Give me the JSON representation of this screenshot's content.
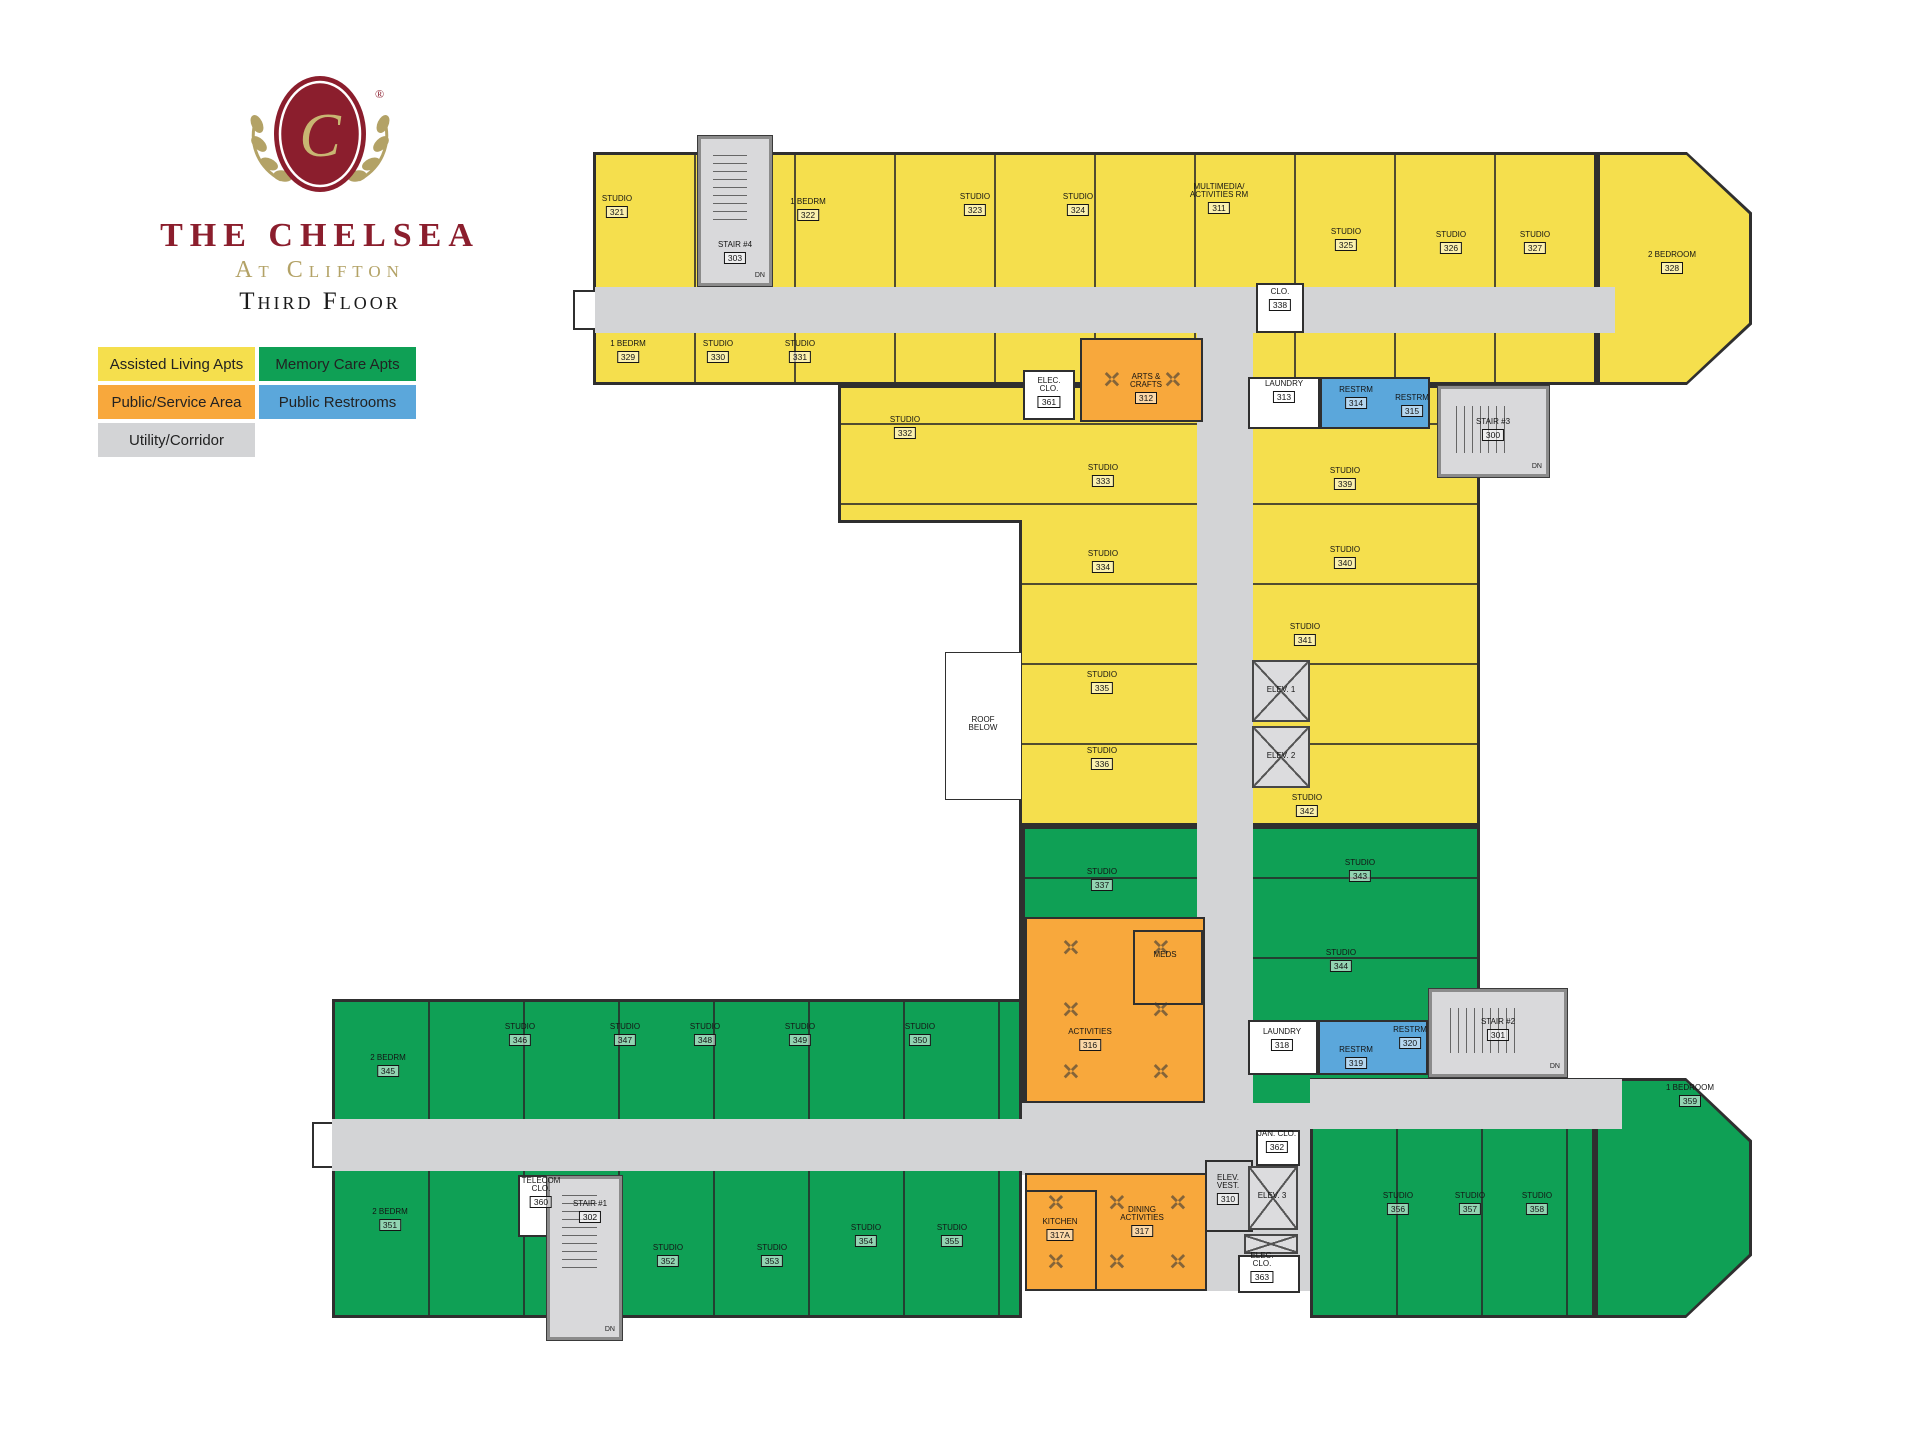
{
  "branding": {
    "monogram": "C",
    "registered": "®",
    "title": "The Chelsea",
    "subtitle": "At Clifton",
    "floor_label": "Third Floor"
  },
  "legend": {
    "items": [
      {
        "label": "Assisted Living Apts",
        "key": "assisted"
      },
      {
        "label": "Memory Care Apts",
        "key": "memory"
      },
      {
        "label": "Public/Service Area",
        "key": "service"
      },
      {
        "label": "Public Restrooms",
        "key": "restroom"
      },
      {
        "label": "Utility/Corridor",
        "key": "corridor"
      }
    ]
  },
  "colors": {
    "assisted": "#F5DF4D",
    "memory": "#0FA055",
    "service": "#F8A83C",
    "restroom": "#5BA7DB",
    "corridor": "#D3D4D6",
    "white": "#FFFFFF",
    "wall": "#2F2F2F",
    "logo_maroon": "#8B1E2D",
    "logo_gold": "#B3A266",
    "text_dark": "#1C1C1C"
  },
  "floorplan": {
    "zones": [
      {
        "name": "top-wing",
        "cat": "assisted",
        "x": 593,
        "y": 152,
        "w": 1004,
        "h": 233,
        "stripes": "v100"
      },
      {
        "name": "top-wing-bay",
        "cat": "assisted",
        "x": 1597,
        "y": 152,
        "w": 155,
        "h": 233,
        "shape": "bay"
      },
      {
        "name": "mid-block",
        "cat": "assisted",
        "x": 838,
        "y": 385,
        "w": 642,
        "h": 441,
        "stripes": "h80"
      },
      {
        "name": "mid-notch",
        "cat": "white",
        "x": 838,
        "y": 520,
        "w": 184,
        "h": 479,
        "edge": "notch"
      },
      {
        "name": "mid-green",
        "cat": "memory",
        "x": 1022,
        "y": 826,
        "w": 458,
        "h": 294,
        "stripes": "h80"
      },
      {
        "name": "bottom-wing",
        "cat": "memory",
        "x": 332,
        "y": 999,
        "w": 690,
        "h": 319,
        "stripes": "v95"
      },
      {
        "name": "bottom-right-wing",
        "cat": "memory",
        "x": 1310,
        "y": 1078,
        "w": 285,
        "h": 240,
        "stripes": "v85"
      },
      {
        "name": "bottom-bay",
        "cat": "memory",
        "x": 1595,
        "y": 1078,
        "w": 157,
        "h": 240,
        "shape": "bay"
      }
    ],
    "corridors": [
      {
        "name": "top-corridor",
        "x": 595,
        "y": 287,
        "w": 1020,
        "h": 46
      },
      {
        "name": "mid-corridor",
        "x": 1197,
        "y": 333,
        "w": 56,
        "h": 838
      },
      {
        "name": "bottom-corridor",
        "x": 332,
        "y": 1119,
        "w": 690,
        "h": 52
      },
      {
        "name": "bottom-right-corridor",
        "x": 1310,
        "y": 1079,
        "w": 312,
        "h": 50
      },
      {
        "name": "central-plaza",
        "x": 1022,
        "y": 1103,
        "w": 288,
        "h": 72
      },
      {
        "name": "elevator-lobby",
        "x": 1205,
        "y": 1129,
        "w": 105,
        "h": 162
      }
    ],
    "entries": [
      {
        "name": "top-corridor-entry",
        "x": 573,
        "y": 290,
        "w": 22,
        "h": 40
      },
      {
        "name": "bottom-corridor-entry",
        "x": 312,
        "y": 1122,
        "w": 20,
        "h": 46
      }
    ],
    "overlays": [
      {
        "name": "arts-crafts-room",
        "cat": "service",
        "x": 1080,
        "y": 338,
        "w": 123,
        "h": 84,
        "tables": [
          2,
          1
        ]
      },
      {
        "name": "activities-room",
        "cat": "service",
        "x": 1025,
        "y": 917,
        "w": 180,
        "h": 186,
        "tables": [
          2,
          3
        ]
      },
      {
        "name": "meds-room",
        "cat": "service",
        "x": 1133,
        "y": 930,
        "w": 70,
        "h": 75
      },
      {
        "name": "dining-room",
        "cat": "service",
        "x": 1025,
        "y": 1173,
        "w": 182,
        "h": 118,
        "tables": [
          3,
          2
        ]
      },
      {
        "name": "kitchen-room",
        "cat": "service",
        "x": 1025,
        "y": 1190,
        "w": 72,
        "h": 101
      },
      {
        "name": "restrooms-314-315",
        "cat": "restroom",
        "x": 1320,
        "y": 377,
        "w": 110,
        "h": 52
      },
      {
        "name": "restrooms-319-320",
        "cat": "restroom",
        "x": 1318,
        "y": 1020,
        "w": 110,
        "h": 55
      },
      {
        "name": "laundry-313-room",
        "cat": "white",
        "x": 1248,
        "y": 377,
        "w": 72,
        "h": 52
      },
      {
        "name": "laundry-318-room",
        "cat": "white",
        "x": 1248,
        "y": 1020,
        "w": 70,
        "h": 55
      },
      {
        "name": "elec-clo-361-room",
        "cat": "white",
        "x": 1023,
        "y": 370,
        "w": 52,
        "h": 50
      },
      {
        "name": "clo-338-room",
        "cat": "white",
        "x": 1256,
        "y": 283,
        "w": 48,
        "h": 50
      },
      {
        "name": "telecom-clo-360-room",
        "cat": "white",
        "x": 518,
        "y": 1175,
        "w": 48,
        "h": 62
      },
      {
        "name": "jan-clo-362-room",
        "cat": "white",
        "x": 1256,
        "y": 1130,
        "w": 44,
        "h": 36
      },
      {
        "name": "elec-clo-363-room",
        "cat": "white",
        "x": 1238,
        "y": 1255,
        "w": 62,
        "h": 38
      },
      {
        "name": "elev-vest-310-room",
        "cat": "corridor",
        "x": 1205,
        "y": 1160,
        "w": 48,
        "h": 72
      },
      {
        "name": "roof-below-box",
        "cat": "white",
        "x": 945,
        "y": 652,
        "w": 77,
        "h": 148,
        "thin": true
      }
    ],
    "stairs": [
      {
        "name": "stair-4-tower",
        "dn": "DN",
        "x": 697,
        "y": 135,
        "w": 76,
        "h": 152,
        "dir": "v"
      },
      {
        "name": "stair-3-tower",
        "dn": "DN",
        "x": 1437,
        "y": 385,
        "w": 113,
        "h": 93,
        "dir": "h"
      },
      {
        "name": "stair-1-tower",
        "dn": "DN",
        "x": 546,
        "y": 1175,
        "w": 77,
        "h": 166,
        "dir": "v"
      },
      {
        "name": "stair-2-tower",
        "dn": "DN",
        "x": 1428,
        "y": 988,
        "w": 140,
        "h": 90,
        "dir": "h"
      }
    ],
    "elevators": [
      {
        "name": "elevator-1",
        "x": 1252,
        "y": 660,
        "w": 58,
        "h": 62
      },
      {
        "name": "elevator-2",
        "x": 1252,
        "y": 726,
        "w": 58,
        "h": 62
      },
      {
        "name": "elevator-3",
        "x": 1248,
        "y": 1166,
        "w": 50,
        "h": 64
      },
      {
        "name": "elevator-shaft",
        "x": 1244,
        "y": 1234,
        "w": 54,
        "h": 20
      }
    ],
    "room_labels": [
      {
        "name": "STUDIO",
        "num": "321",
        "x": 617,
        "y": 207
      },
      {
        "name": "1 BEDRM",
        "num": "322",
        "x": 808,
        "y": 210
      },
      {
        "name": "STUDIO",
        "num": "323",
        "x": 975,
        "y": 205
      },
      {
        "name": "STUDIO",
        "num": "324",
        "x": 1078,
        "y": 205
      },
      {
        "name": "MULTIMEDIA/|ACTIVITIES RM",
        "num": "311",
        "x": 1219,
        "y": 199
      },
      {
        "name": "STUDIO",
        "num": "325",
        "x": 1346,
        "y": 240
      },
      {
        "name": "STUDIO",
        "num": "326",
        "x": 1451,
        "y": 243
      },
      {
        "name": "STUDIO",
        "num": "327",
        "x": 1535,
        "y": 243
      },
      {
        "name": "2 BEDROOM",
        "num": "328",
        "x": 1672,
        "y": 263
      },
      {
        "name": "1 BEDRM",
        "num": "329",
        "x": 628,
        "y": 352
      },
      {
        "name": "STUDIO",
        "num": "330",
        "x": 718,
        "y": 352
      },
      {
        "name": "STUDIO",
        "num": "331",
        "x": 800,
        "y": 352
      },
      {
        "name": "STUDIO",
        "num": "332",
        "x": 905,
        "y": 428
      },
      {
        "name": "STUDIO",
        "num": "333",
        "x": 1103,
        "y": 476
      },
      {
        "name": "STUDIO",
        "num": "334",
        "x": 1103,
        "y": 562
      },
      {
        "name": "STUDIO",
        "num": "335",
        "x": 1102,
        "y": 683
      },
      {
        "name": "STUDIO",
        "num": "336",
        "x": 1102,
        "y": 759
      },
      {
        "name": "STUDIO",
        "num": "337",
        "x": 1102,
        "y": 880
      },
      {
        "name": "STUDIO",
        "num": "339",
        "x": 1345,
        "y": 479
      },
      {
        "name": "STUDIO",
        "num": "340",
        "x": 1345,
        "y": 558
      },
      {
        "name": "STUDIO",
        "num": "341",
        "x": 1305,
        "y": 635
      },
      {
        "name": "STUDIO",
        "num": "342",
        "x": 1307,
        "y": 806
      },
      {
        "name": "STUDIO",
        "num": "343",
        "x": 1360,
        "y": 871
      },
      {
        "name": "STUDIO",
        "num": "344",
        "x": 1341,
        "y": 961
      },
      {
        "name": "2 BEDRM",
        "num": "345",
        "x": 388,
        "y": 1066
      },
      {
        "name": "STUDIO",
        "num": "346",
        "x": 520,
        "y": 1035
      },
      {
        "name": "STUDIO",
        "num": "347",
        "x": 625,
        "y": 1035
      },
      {
        "name": "STUDIO",
        "num": "348",
        "x": 705,
        "y": 1035
      },
      {
        "name": "STUDIO",
        "num": "349",
        "x": 800,
        "y": 1035
      },
      {
        "name": "STUDIO",
        "num": "350",
        "x": 920,
        "y": 1035
      },
      {
        "name": "2 BEDRM",
        "num": "351",
        "x": 390,
        "y": 1220
      },
      {
        "name": "STUDIO",
        "num": "352",
        "x": 668,
        "y": 1256
      },
      {
        "name": "STUDIO",
        "num": "353",
        "x": 772,
        "y": 1256
      },
      {
        "name": "STUDIO",
        "num": "354",
        "x": 866,
        "y": 1236
      },
      {
        "name": "STUDIO",
        "num": "355",
        "x": 952,
        "y": 1236
      },
      {
        "name": "STUDIO",
        "num": "356",
        "x": 1398,
        "y": 1204
      },
      {
        "name": "STUDIO",
        "num": "357",
        "x": 1470,
        "y": 1204
      },
      {
        "name": "STUDIO",
        "num": "358",
        "x": 1537,
        "y": 1204
      },
      {
        "name": "1 BEDROOM",
        "num": "359",
        "x": 1690,
        "y": 1096
      },
      {
        "name": "ELEC.|CLO.",
        "num": "361",
        "x": 1049,
        "y": 393
      },
      {
        "name": "ARTS &|CRAFTS",
        "num": "312",
        "x": 1146,
        "y": 389
      },
      {
        "name": "LAUNDRY",
        "num": "313",
        "x": 1284,
        "y": 392
      },
      {
        "name": "RESTRM",
        "num": "314",
        "x": 1356,
        "y": 398
      },
      {
        "name": "RESTRM",
        "num": "315",
        "x": 1412,
        "y": 406
      },
      {
        "name": "CLO.",
        "num": "338",
        "x": 1280,
        "y": 300
      },
      {
        "name": "STAIR #4",
        "num": "303",
        "x": 735,
        "y": 253
      },
      {
        "name": "STAIR #3",
        "num": "300",
        "x": 1493,
        "y": 430
      },
      {
        "name": "ROOF|BELOW",
        "num": "",
        "x": 983,
        "y": 724
      },
      {
        "name": "ELEV. 1",
        "num": "",
        "x": 1281,
        "y": 690
      },
      {
        "name": "ELEV. 2",
        "num": "",
        "x": 1281,
        "y": 756
      },
      {
        "name": "ACTIVITIES",
        "num": "316",
        "x": 1090,
        "y": 1040
      },
      {
        "name": "MEDS",
        "num": "",
        "x": 1165,
        "y": 955
      },
      {
        "name": "LAUNDRY",
        "num": "318",
        "x": 1282,
        "y": 1040
      },
      {
        "name": "RESTRM",
        "num": "319",
        "x": 1356,
        "y": 1058
      },
      {
        "name": "RESTRM",
        "num": "320",
        "x": 1410,
        "y": 1038
      },
      {
        "name": "STAIR #2",
        "num": "301",
        "x": 1498,
        "y": 1030
      },
      {
        "name": "TELECOM|CLO.",
        "num": "360",
        "x": 541,
        "y": 1193
      },
      {
        "name": "STAIR #1",
        "num": "302",
        "x": 590,
        "y": 1212
      },
      {
        "name": "KITCHEN",
        "num": "317A",
        "x": 1060,
        "y": 1230
      },
      {
        "name": "DINING|ACTIVITIES",
        "num": "317",
        "x": 1142,
        "y": 1222
      },
      {
        "name": "ELEV.|VEST.",
        "num": "310",
        "x": 1228,
        "y": 1190
      },
      {
        "name": "JAN. CLO.",
        "num": "362",
        "x": 1277,
        "y": 1142
      },
      {
        "name": "ELEV. 3",
        "num": "",
        "x": 1272,
        "y": 1196
      },
      {
        "name": "ELEC.|CLO.",
        "num": "363",
        "x": 1262,
        "y": 1268
      }
    ]
  }
}
